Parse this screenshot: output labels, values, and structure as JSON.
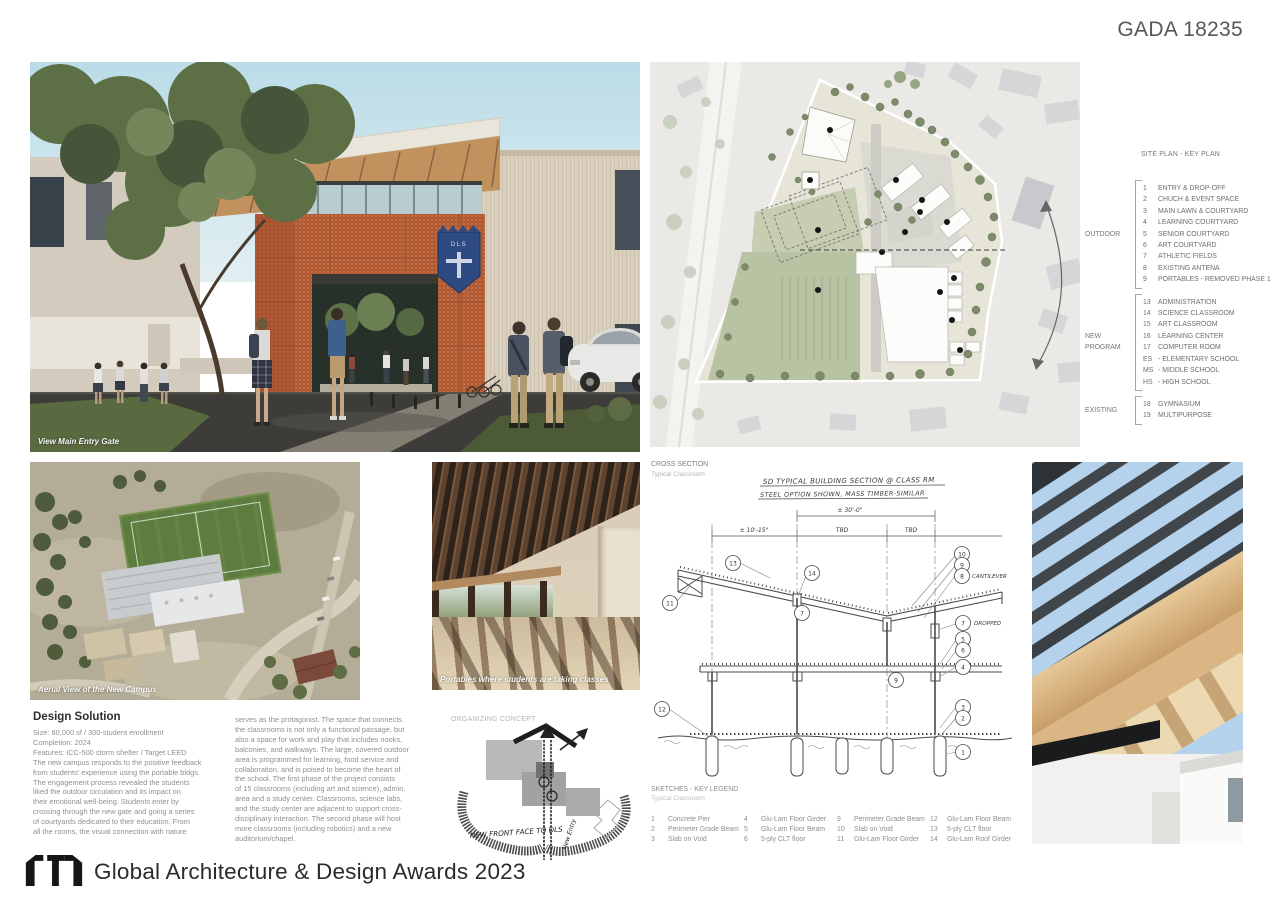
{
  "board": {
    "id": "GADA 18235"
  },
  "render": {
    "caption": "View Main Entry Gate",
    "shield": "DLS"
  },
  "siteplan": {
    "title": "SITE PLAN - KEY PLAN",
    "groups": [
      {
        "name": "OUTDOOR",
        "items": [
          {
            "code": "1",
            "label": "ENTRY & DROP-OFF"
          },
          {
            "code": "2",
            "label": "CHUCH & EVENT SPACE"
          },
          {
            "code": "3",
            "label": "MAIN LAWN & COURTYARD"
          },
          {
            "code": "4",
            "label": "LEARNING COURTYARD"
          },
          {
            "code": "5",
            "label": "SENIOR COURTYARD"
          },
          {
            "code": "6",
            "label": "ART COURTYARD"
          },
          {
            "code": "7",
            "label": "ATHLETIC FIELDS"
          },
          {
            "code": "8",
            "label": "EXISTING ANTENA"
          },
          {
            "code": "9",
            "label": "PORTABLES - REMOVED PHASE 1"
          }
        ]
      },
      {
        "name": "NEW PROGRAM",
        "items": [
          {
            "code": "13",
            "label": "ADMINISTRATION"
          },
          {
            "code": "14",
            "label": "SCIENCE CLASSROOM"
          },
          {
            "code": "15",
            "label": "ART CLASSROOM"
          },
          {
            "code": "16",
            "label": "LEARNING CENTER"
          },
          {
            "code": "17",
            "label": "COMPUTER ROOM"
          },
          {
            "code": "ES",
            "label": "- ELEMENTARY SCHOOL"
          },
          {
            "code": "MS",
            "label": "- MIDDLE SCHOOL"
          },
          {
            "code": "HS",
            "label": "- HIGH SCHOOL"
          }
        ]
      },
      {
        "name": "EXISTING",
        "items": [
          {
            "code": "18",
            "label": "GYMNASIUM"
          },
          {
            "code": "19",
            "label": "MULTIPURPOSE"
          }
        ]
      }
    ]
  },
  "aerial": {
    "caption": "Aerial View of the New Campus"
  },
  "walkway": {
    "caption": "Portables where students are taking classes"
  },
  "section": {
    "label": "CROSS SECTION",
    "sublabel": "Typical Classroom",
    "title1": "SD TYPICAL BUILDING SECTION @ CLASS RM",
    "title2": "STEEL OPTION SHOWN, MASS TIMBER-SIMILAR",
    "dim_top": "± 30'-0\"",
    "dim_left": "± 10'-15\"",
    "dim_mid": "TBD",
    "dim_right": "TBD",
    "cantilever": "CANTILEVER",
    "dropped": "DROPPED",
    "callouts": [
      "13",
      "11",
      "14",
      "7",
      "12",
      "9",
      "10",
      "9",
      "8",
      "7",
      "5",
      "6",
      "4",
      "3",
      "2",
      "1"
    ]
  },
  "concept": {
    "label": "ORGANIZING CONCEPT",
    "front": "NEW FRONT FACE TO DLS",
    "entry": "New Entry"
  },
  "solution": {
    "title": "Design Solution",
    "col1": "Size: 80,000 sf  / 300-student enrollment\nCompletion: 2024\nFeatures: ICC-500 storm shelter / Target LEED\nThe new campus responds to the positive feedback\nfrom students' experience using the portable bldgs.\nThe engagement process revealed the students\nliked the outdoor circulation and its impact on\ntheir emotional well-being. Students enter by\ncrossing through the new gate and going a series\nof courtyards dedicated to their education. From\nall the rooms, the visual connection with nature",
    "col2": "serves as the protagonist. The space that connects\nthe classrooms is not only a functional passage, but\nalso a space for work and play that includes nooks,\nbalconies, and walkways. The large, covered outdoor\narea is programmed for learning, food service and\ncollaboration, and is poised to become the heart of\nthe school. The first phase of the project consists\nof 15 classrooms (including art and science), admin.\narea and a study center. Classrooms, science labs,\nand the study center are adjacent to support cross-\ndisciplinary interaction. The second phase will host\nmore classrooms (including robotics) and a new\nauditorium/chapel."
  },
  "sketchlegend": {
    "title": "SKETCHES - KEY LEGEND",
    "subtitle": "Typical Classroom",
    "cols": [
      {
        "items": [
          {
            "code": "1",
            "label": "Concrete Pier"
          },
          {
            "code": "2",
            "label": "Perimeter Grade Beam"
          },
          {
            "code": "3",
            "label": "Slab on Void"
          }
        ]
      },
      {
        "items": [
          {
            "code": "4",
            "label": "Glu-Lam Floor Girder"
          },
          {
            "code": "5",
            "label": "Glu-Lam Floor Beam"
          },
          {
            "code": "6",
            "label": "5-ply CLT floor"
          }
        ]
      },
      {
        "items": [
          {
            "code": "9",
            "label": "Perimeter Grade Beam"
          },
          {
            "code": "10",
            "label": "Slab on Void"
          },
          {
            "code": "11",
            "label": "Glu-Lam Floor Girder"
          }
        ]
      },
      {
        "items": [
          {
            "code": "12",
            "label": "Glu-Lam Floor Beam"
          },
          {
            "code": "13",
            "label": "5-ply CLT floor"
          },
          {
            "code": "14",
            "label": "Glu-Lam Roof Girder"
          }
        ]
      }
    ]
  },
  "footer": {
    "text": "Global Architecture & Design Awards 2023"
  },
  "colors": {
    "corten": "#b25a34",
    "shield_blue": "#2d4b80",
    "site_green": "#b8c3a3",
    "field_green": "#5e7c3f"
  }
}
